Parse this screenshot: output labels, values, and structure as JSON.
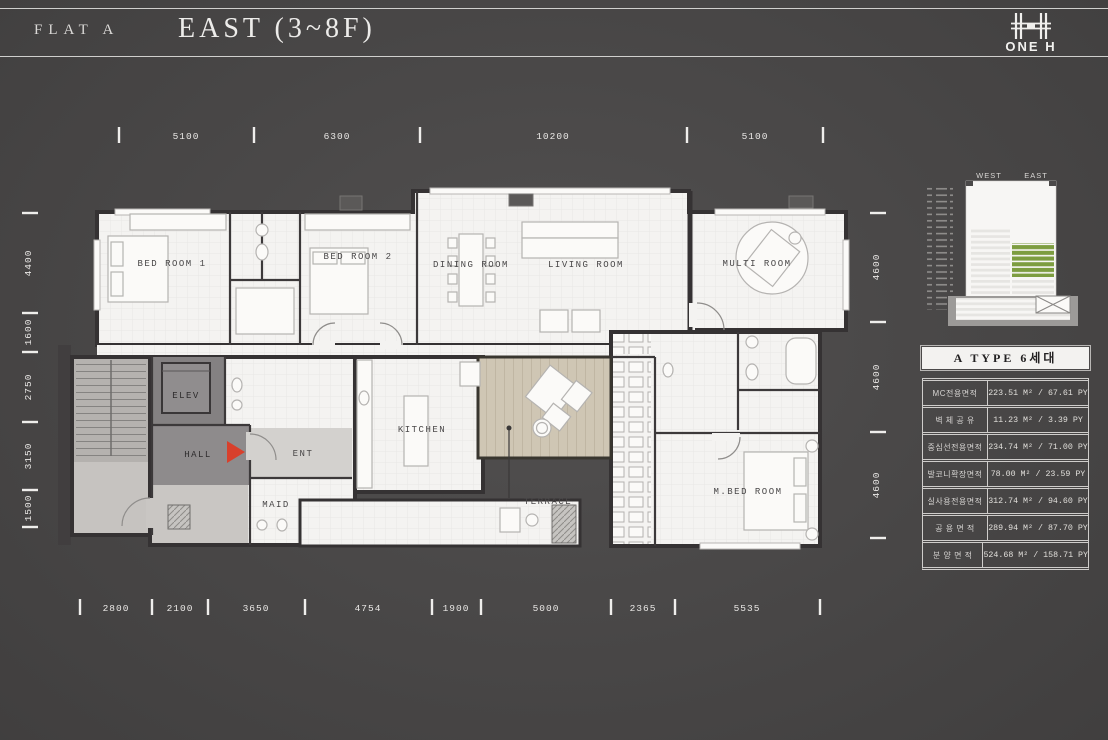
{
  "header": {
    "flat_label": "FLAT A",
    "title": "EAST (3~8F)",
    "brand": "ONE H"
  },
  "dimensions": {
    "top": [
      "5100",
      "6300",
      "10200",
      "5100"
    ],
    "bottom": [
      "2800",
      "2100",
      "3650",
      "4754",
      "1900",
      "5000",
      "2365",
      "5535"
    ],
    "left": [
      "4400",
      "1600",
      "2750",
      "3150",
      "1500"
    ],
    "right": [
      "4600",
      "4600",
      "4600"
    ]
  },
  "rooms": {
    "bedroom1": "BED ROOM 1",
    "bedroom2": "BED ROOM 2",
    "dining": "DINING ROOM",
    "living": "LIVING ROOM",
    "multi": "MULTI ROOM",
    "elev": "ELEV",
    "hall": "HALL",
    "ent": "ENT",
    "maid": "MAID",
    "kitchen": "KITCHEN",
    "terrace": "TERRACE",
    "mbed": "M.BED ROOM"
  },
  "key_plan": {
    "west": "WEST",
    "east": "EAST"
  },
  "area_table": {
    "title": "A TYPE 6세대",
    "rows": [
      {
        "label": "MC전용면적",
        "value": "223.51 M² / 67.61 PY"
      },
      {
        "label": "벽 체 공 유",
        "value": "11.23 M² / 3.39 PY"
      },
      {
        "label": "중심선전용면적",
        "value": "234.74 M² / 71.00 PY"
      },
      {
        "label": "발코니확장면적",
        "value": "78.00 M² / 23.59 PY"
      },
      {
        "label": "실사용전용면적",
        "value": "312.74 M² / 94.60 PY"
      },
      {
        "label": "공 용 면 적",
        "value": "289.94 M² / 87.70 PY"
      },
      {
        "label": "분 양 면 적",
        "value": "524.68 M² / 158.71 PY"
      }
    ]
  },
  "colors": {
    "background": "#4b4949",
    "accent_green": "#7d9d40",
    "marker_red": "#d8402c",
    "plan_floor": "#f4f3f1",
    "wall": "#353233",
    "terrace_wood": "#cfc6b4"
  }
}
